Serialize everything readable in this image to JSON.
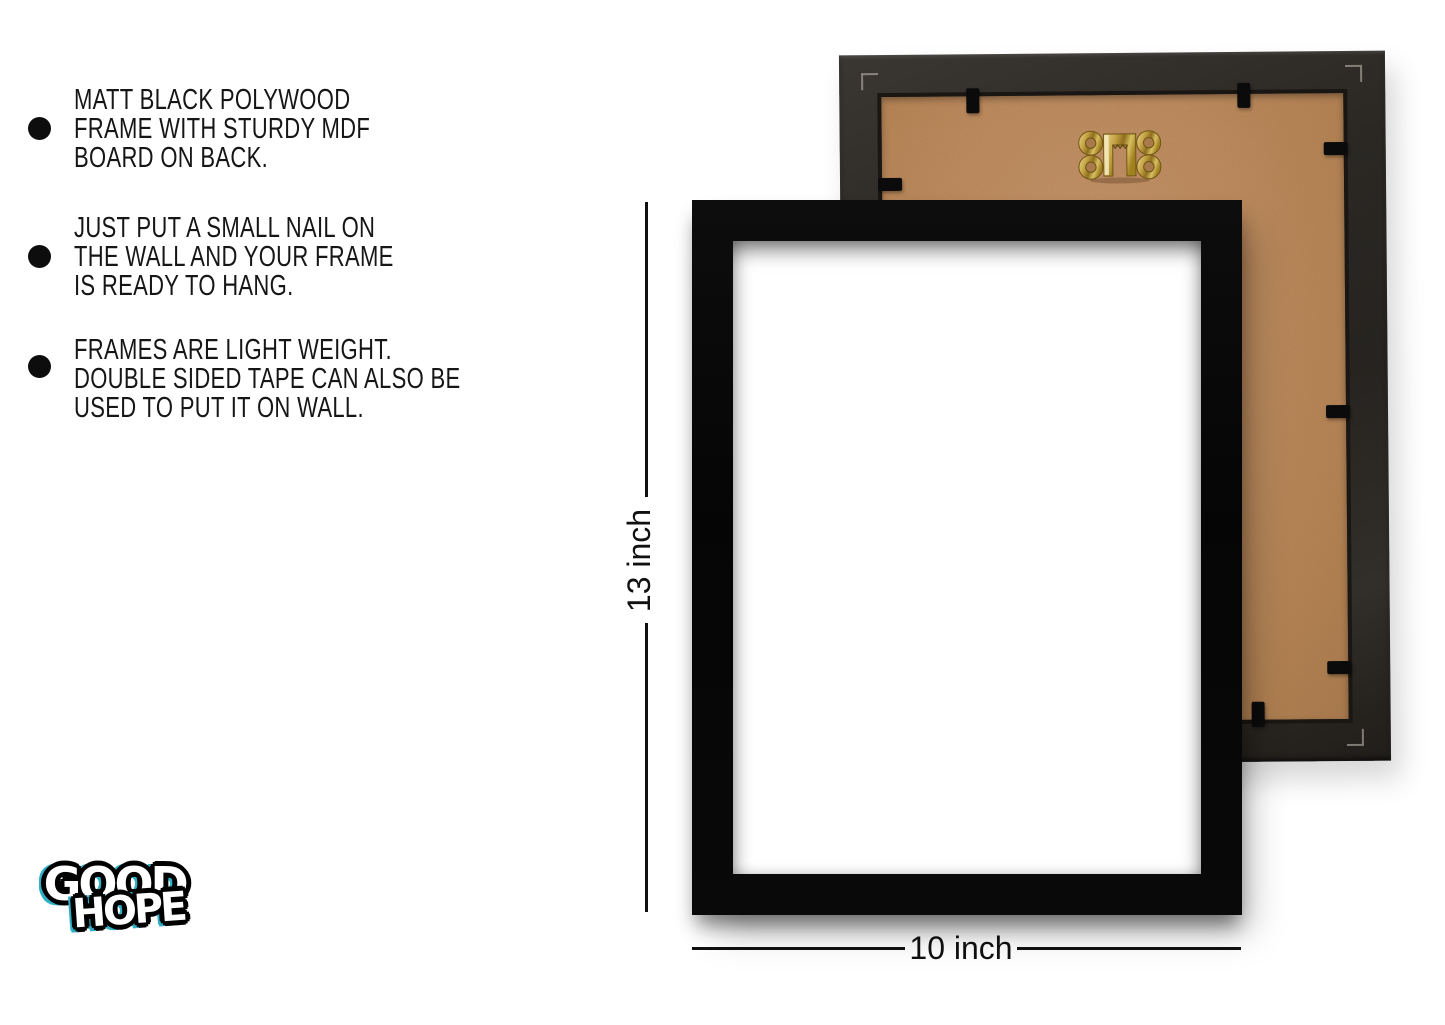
{
  "page": {
    "background": "#ffffff"
  },
  "features": {
    "items": [
      {
        "lines": [
          "MATT BLACK POLYWOOD",
          "FRAME WITH STURDY MDF",
          "BOARD ON BACK."
        ]
      },
      {
        "lines": [
          "JUST PUT A SMALL NAIL ON",
          "THE WALL AND YOUR FRAME",
          "IS READY TO HANG."
        ]
      },
      {
        "lines": [
          "FRAMES ARE LIGHT WEIGHT.",
          "DOUBLE SIDED TAPE CAN ALSO BE",
          "USED TO PUT IT ON WALL."
        ]
      }
    ]
  },
  "dimensions": {
    "height": "13 inch",
    "width": "10 inch"
  },
  "logo": {
    "word1": "GOOD",
    "word2": "HOPE"
  },
  "icons": {
    "bullet": "filled-circle",
    "hanging_hook": "brass-picture-hanger",
    "retainer_clip": "black-flexi-tab"
  },
  "colors": {
    "frame_black": "#070707",
    "back_frame_border": "#2c2926",
    "mdf_board": "#bd8a5e",
    "hook_gold": "#c9a43c",
    "clip_black": "#0b0b0b",
    "logo_accent": "#2fb0c6",
    "text": "#161616",
    "dimension_line": "#101010"
  }
}
